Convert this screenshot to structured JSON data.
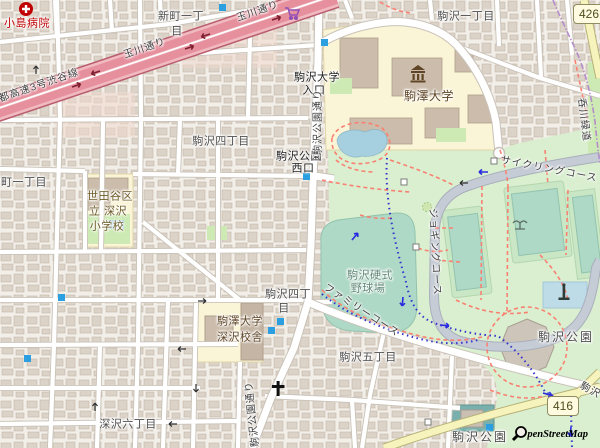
{
  "labels": {
    "hospital": "小島病院",
    "shinmachi_line1": "新町一丁",
    "shinmachi_line2": "目",
    "tamagawa_dori_1": "玉川通り",
    "tamagawa_dori_2": "玉川通り",
    "shuto_expressway": "首都高速3号渋谷線",
    "komazawa_1chome": "駒沢一丁目",
    "komazawa_4chome_north": "駒沢四丁目",
    "machi_1chome": "町一丁目",
    "komazawa_univ_entrance_line1": "駒沢大学",
    "komazawa_univ_entrance_line2": "入口",
    "komazawa_park_west_gate_line1": "駒沢公園",
    "komazawa_park_west_gate_line2": "西口",
    "komazawa_park_dori_north": "駒沢公園通り",
    "komazawa_park_dori_south": "駒沢公園通り",
    "komazawa_university": "駒澤大学",
    "setagaya_school_line1": "世田谷区",
    "setagaya_school_line2": "立 深沢",
    "setagaya_school_line3": "小学校",
    "cycling_course": "サイクリングコース",
    "jogging_course": "ジョギングコース",
    "family_course": "ファミリーコース",
    "baseball_field_line1": "駒沢硬式",
    "baseball_field_line2": "野球場",
    "komazawa_4chome_mid_line1": "駒沢四丁",
    "komazawa_4chome_mid_line2": "目",
    "fukasawa_campus_line1": "駒澤大学",
    "fukasawa_campus_line2": "深沢校舎",
    "komazawa_5chome": "駒沢五丁目",
    "fukasawa_6chome": "深沢六丁目",
    "komazawa_park_east": "駒沢公園",
    "komazawa_park_south": "駒沢公園",
    "nomikawa_greenway": "呑川緑道",
    "route_416_roadname": "駒沢"
  },
  "route_badges": {
    "r426": "426",
    "r416": "416"
  },
  "attribution_text": "penStreetMap",
  "icons": {
    "hospital-icon": "red circle with white cross",
    "supermarket-icon": "purple shopping cart",
    "museum-icon": "brown classical building (university)",
    "church-icon": "black cross",
    "fountain-icon": "gray fountain",
    "monument-icon": "dark statue marker",
    "subway-entrance-icon": "small blue square",
    "gate-icon": "small gray square",
    "openstreetmap-magnifier-icon": "magnifying glass of OSM logo"
  },
  "colors": {
    "background": "#f2efe9",
    "building": "#dbd2c8",
    "park_green": "#d9efcf",
    "pitch_teal": "#aed9c6",
    "campus_yellow": "#fbf5d7",
    "motorway_pink": "#e6909e",
    "water_blue": "#a6cfdf",
    "footpath_red": "#fa8072",
    "cycle_route_blue": "#3333cc",
    "boundary_purple": "#b48ccb",
    "marker_blue": "#2b9fe0",
    "secondary_yellow": "#f6f3bd"
  }
}
